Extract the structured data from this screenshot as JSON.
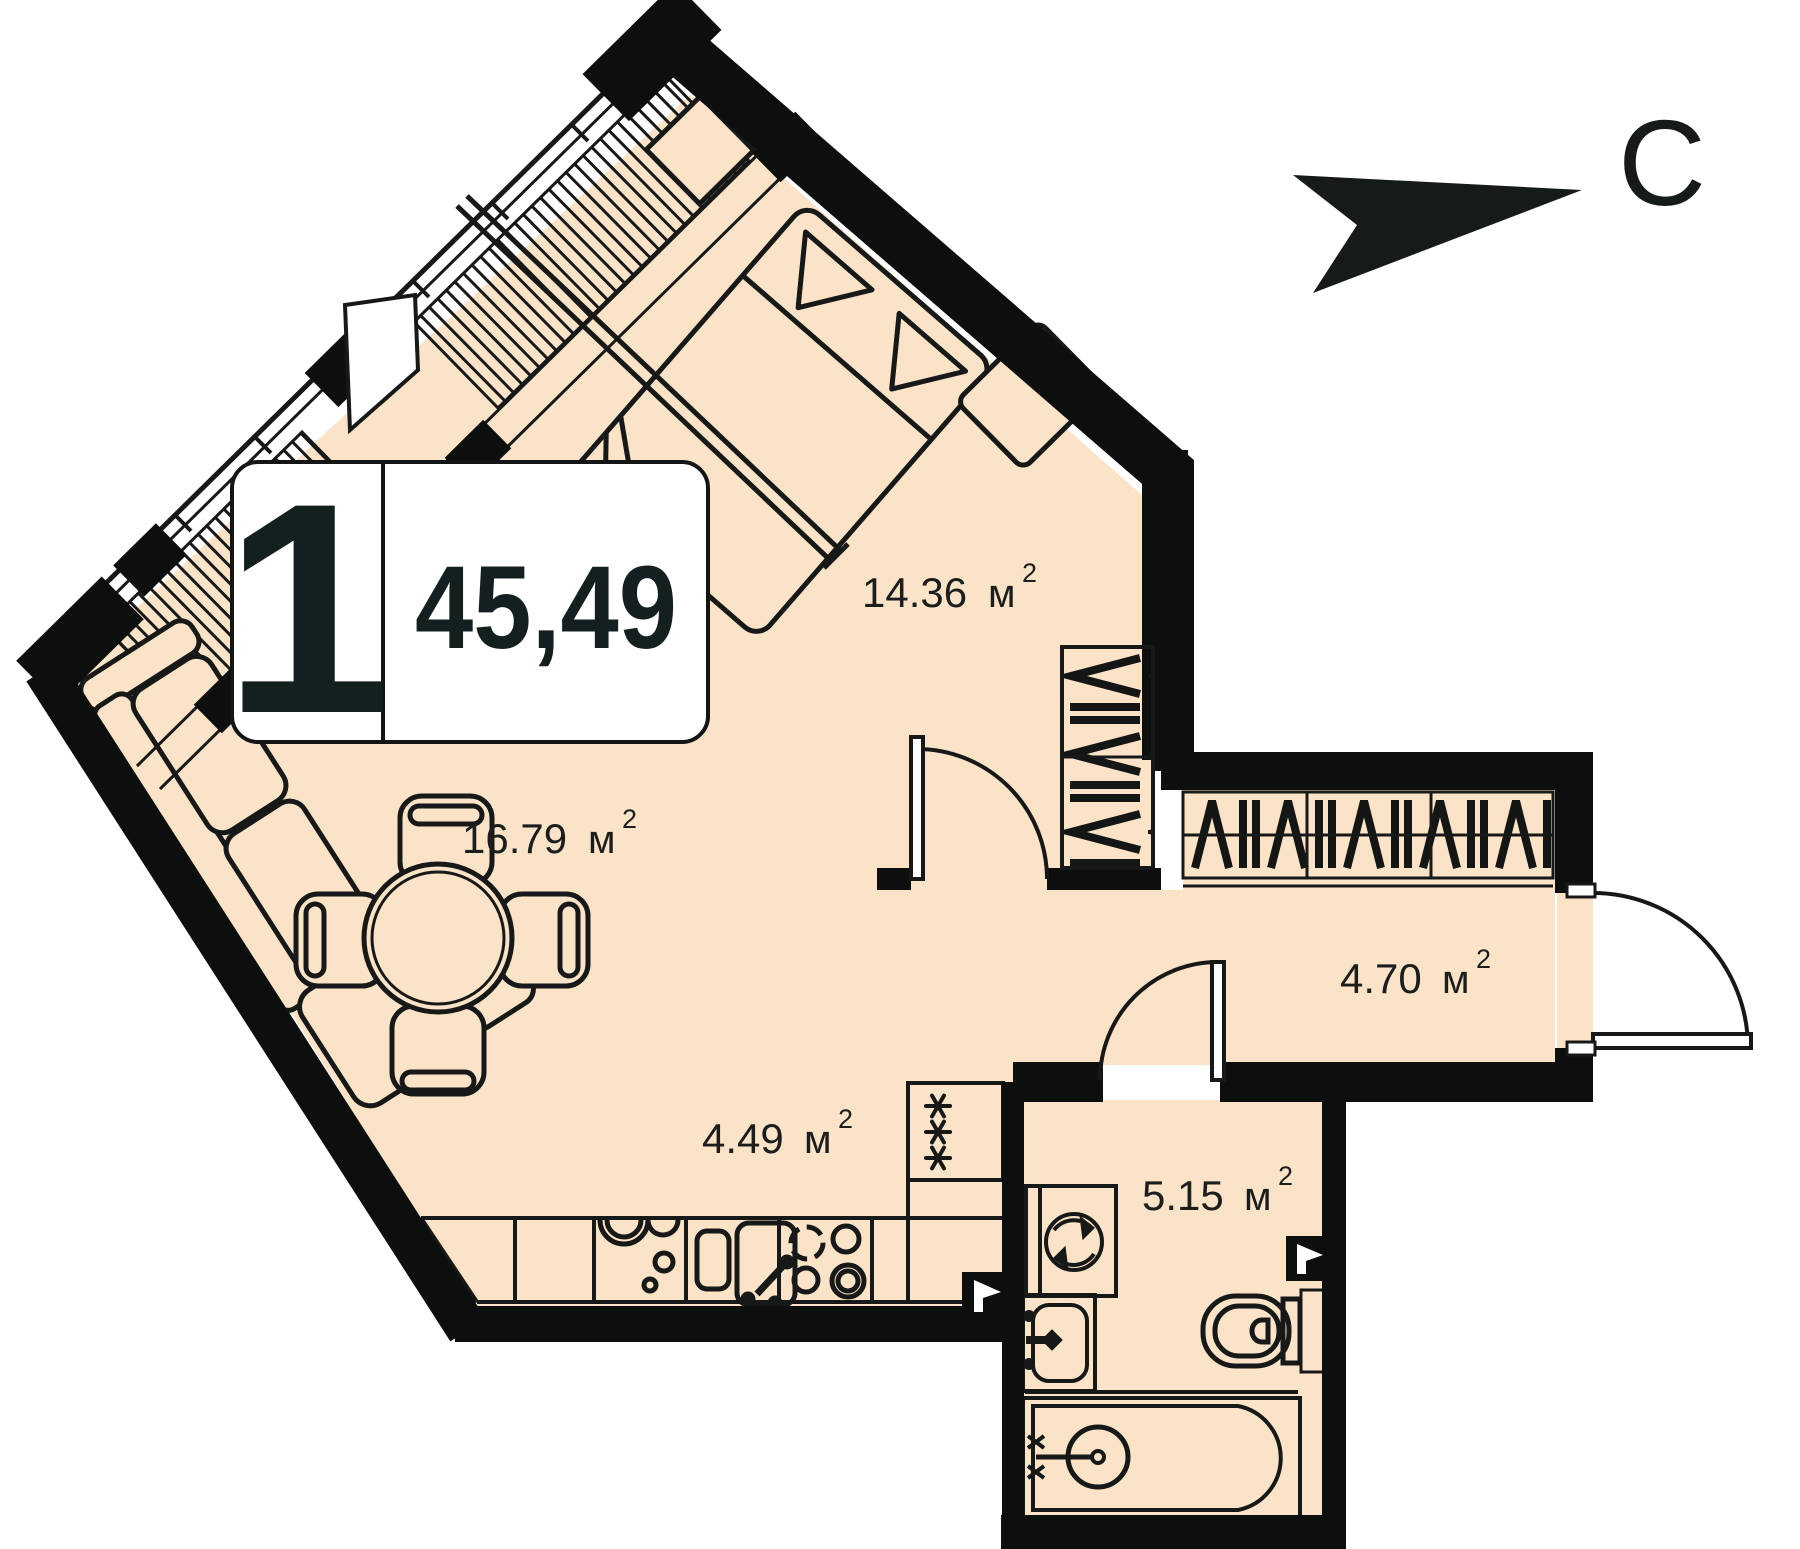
{
  "badge": {
    "rooms_count": "1",
    "total_area": "45,49"
  },
  "compass": {
    "north_label": "С"
  },
  "unit": {
    "symbol": "м",
    "sup": "2"
  },
  "rooms": [
    {
      "name": "bedroom",
      "area": "14.36"
    },
    {
      "name": "living-room",
      "area": "16.79"
    },
    {
      "name": "kitchen",
      "area": "4.49"
    },
    {
      "name": "hallway",
      "area": "4.70"
    },
    {
      "name": "bathroom",
      "area": "5.15"
    }
  ],
  "colors": {
    "floor": "#fbe3c7",
    "wall": "#0d0f0e",
    "line": "#171918",
    "background": "#ffffff"
  }
}
